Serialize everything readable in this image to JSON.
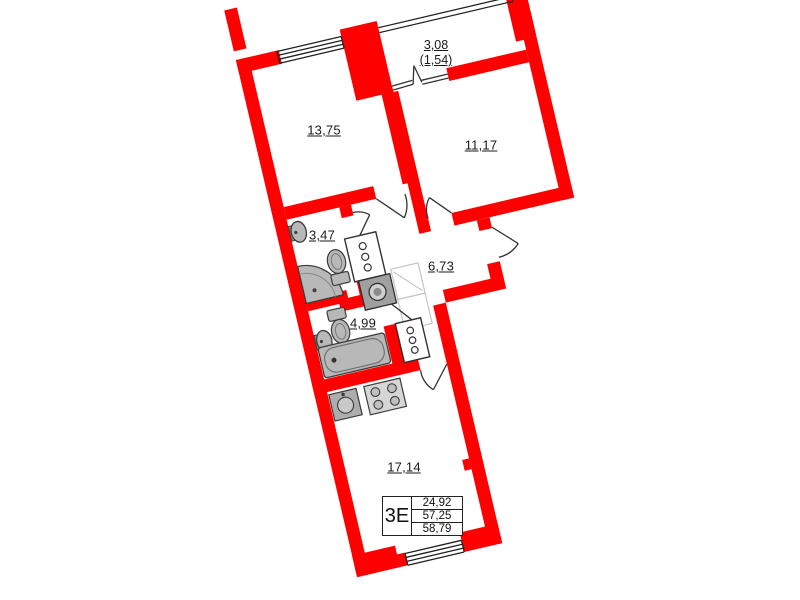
{
  "plan": {
    "title": "apartment-floor-plan",
    "rooms": [
      {
        "id": "room-13-75",
        "area": "13,75"
      },
      {
        "id": "room-11-17",
        "area": "11,17"
      },
      {
        "id": "bathroom-3-47",
        "area": "3,47"
      },
      {
        "id": "hallway-6-73",
        "area": "6,73"
      },
      {
        "id": "bathroom-4-99",
        "area": "4,99"
      },
      {
        "id": "kitchen-living-17-14",
        "area": "17,14"
      }
    ],
    "balcony": {
      "dim_full": "3,08",
      "dim_half": "(1,54)"
    },
    "info_table": {
      "type": "3Е",
      "rows": [
        "24,92",
        "57,25",
        "58,79"
      ]
    },
    "colors": {
      "wall": "#ff0000",
      "fixture": "#b8b8b8",
      "fixture_outline": "#3c3c3c",
      "thin_line": "#222222"
    }
  }
}
